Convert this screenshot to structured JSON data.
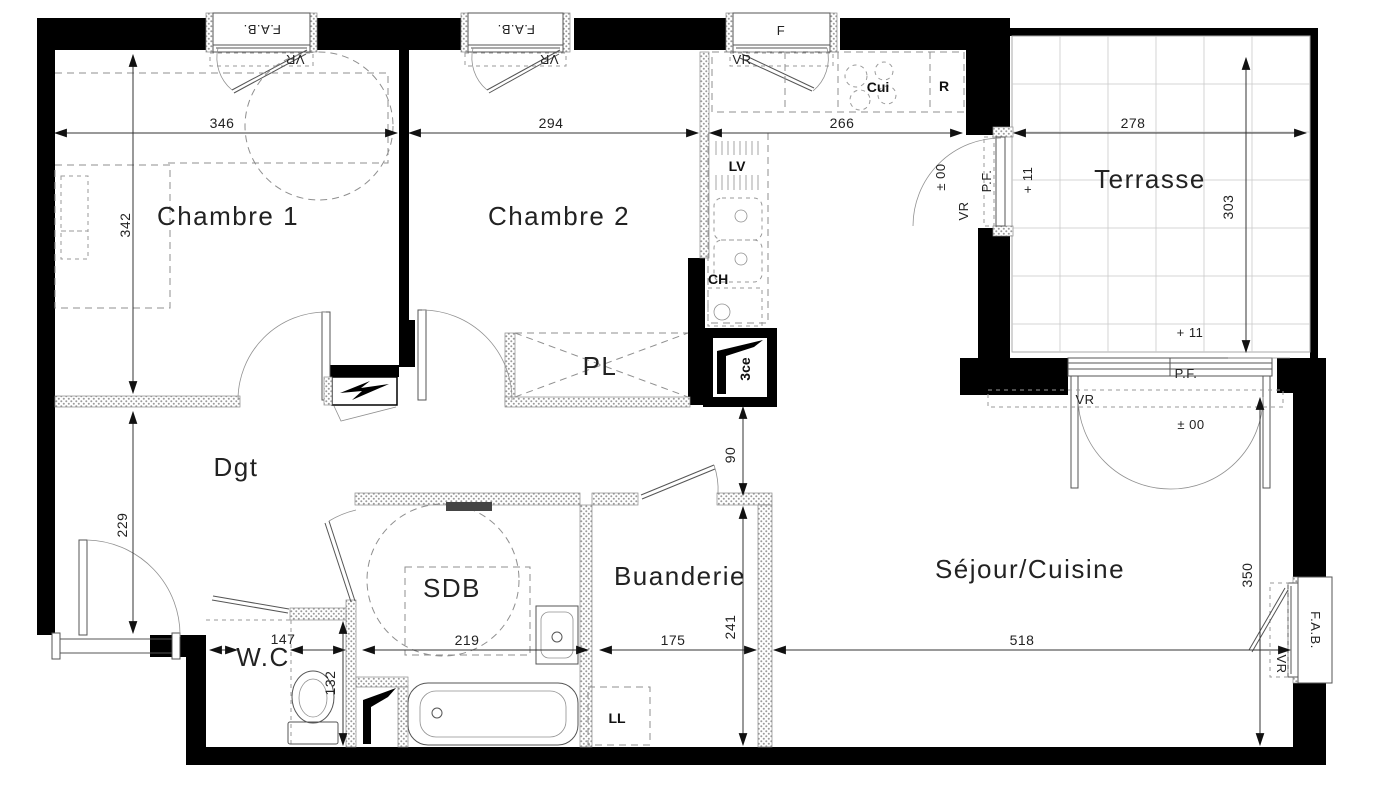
{
  "plan": {
    "rooms": {
      "ch1": "Chambre 1",
      "ch2": "Chambre 2",
      "terrace": "Terrasse",
      "dgt": "Dgt",
      "sdb": "SDB",
      "wc": "W.C",
      "laundry": "Buanderie",
      "living": "Séjour/Cuisine",
      "closet": "PL"
    },
    "fixtures": {
      "cooktop": "Cui",
      "fridge": "R",
      "dishwasher": "LV",
      "water_heater": "CH",
      "washer": "LL",
      "cellar": "3ce"
    },
    "openings": {
      "fab": "F.A.B.",
      "f": "F",
      "vr": "VR",
      "pf": "P.F."
    },
    "levels": {
      "ground": "± 00",
      "terrace": "+ 11"
    },
    "dims": {
      "ch1_w": "346",
      "ch2_w": "294",
      "kitchen_w": "266",
      "terrace_w": "278",
      "ch1_h": "342",
      "terrace_h": "303",
      "dgt_h": "229",
      "wc_w": "147",
      "wc_h": "132",
      "sdb_w": "219",
      "laundry_w": "175",
      "laundry_h": "241",
      "passage": "90",
      "living_w": "518",
      "living_h": "350"
    },
    "colors": {
      "wall": "#000000",
      "thin_line": "#555555",
      "dashed": "#8f8f8f",
      "text": "#1a1a1a",
      "background": "#ffffff"
    }
  }
}
